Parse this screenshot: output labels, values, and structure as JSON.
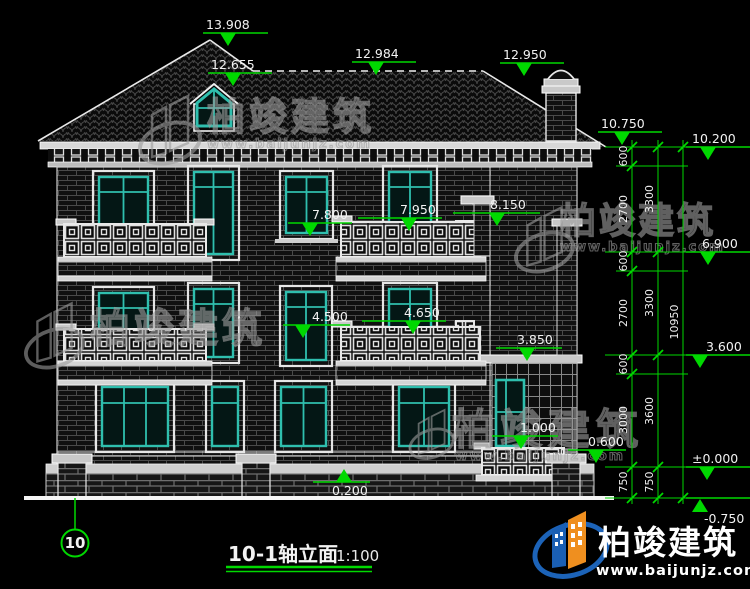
{
  "drawing": {
    "title": "10-1轴立面",
    "scale": "1:100",
    "axis": "10",
    "levels": {
      "v13908": "13.908",
      "v12655": "12.655",
      "v12984": "12.984",
      "v12950": "12.950",
      "v10750": "10.750",
      "v10200": "10.200",
      "v8150": "8.150",
      "v7950": "7.950",
      "v7800": "7.800",
      "v6900": "6.900",
      "v4650": "4.650",
      "v4500": "4.500",
      "v3850": "3.850",
      "v3600": "3.600",
      "v1000": "1.000",
      "v0600": "0.600",
      "v0200": "0.200",
      "v0000": "±0.000",
      "vm0750": "-0.750"
    },
    "dims": {
      "storey": [
        "600",
        "2700",
        "600",
        "2700",
        "600",
        "3000",
        "750"
      ],
      "floor": [
        "3300",
        "3300",
        "3600",
        "750"
      ],
      "total": "10950"
    },
    "watermark": {
      "brand": "柏竣建筑",
      "url": "www.baijunjz.com"
    },
    "colors": {
      "green": "#00d800",
      "teal": "#2fbfae",
      "line": "#e8e8e8"
    }
  }
}
